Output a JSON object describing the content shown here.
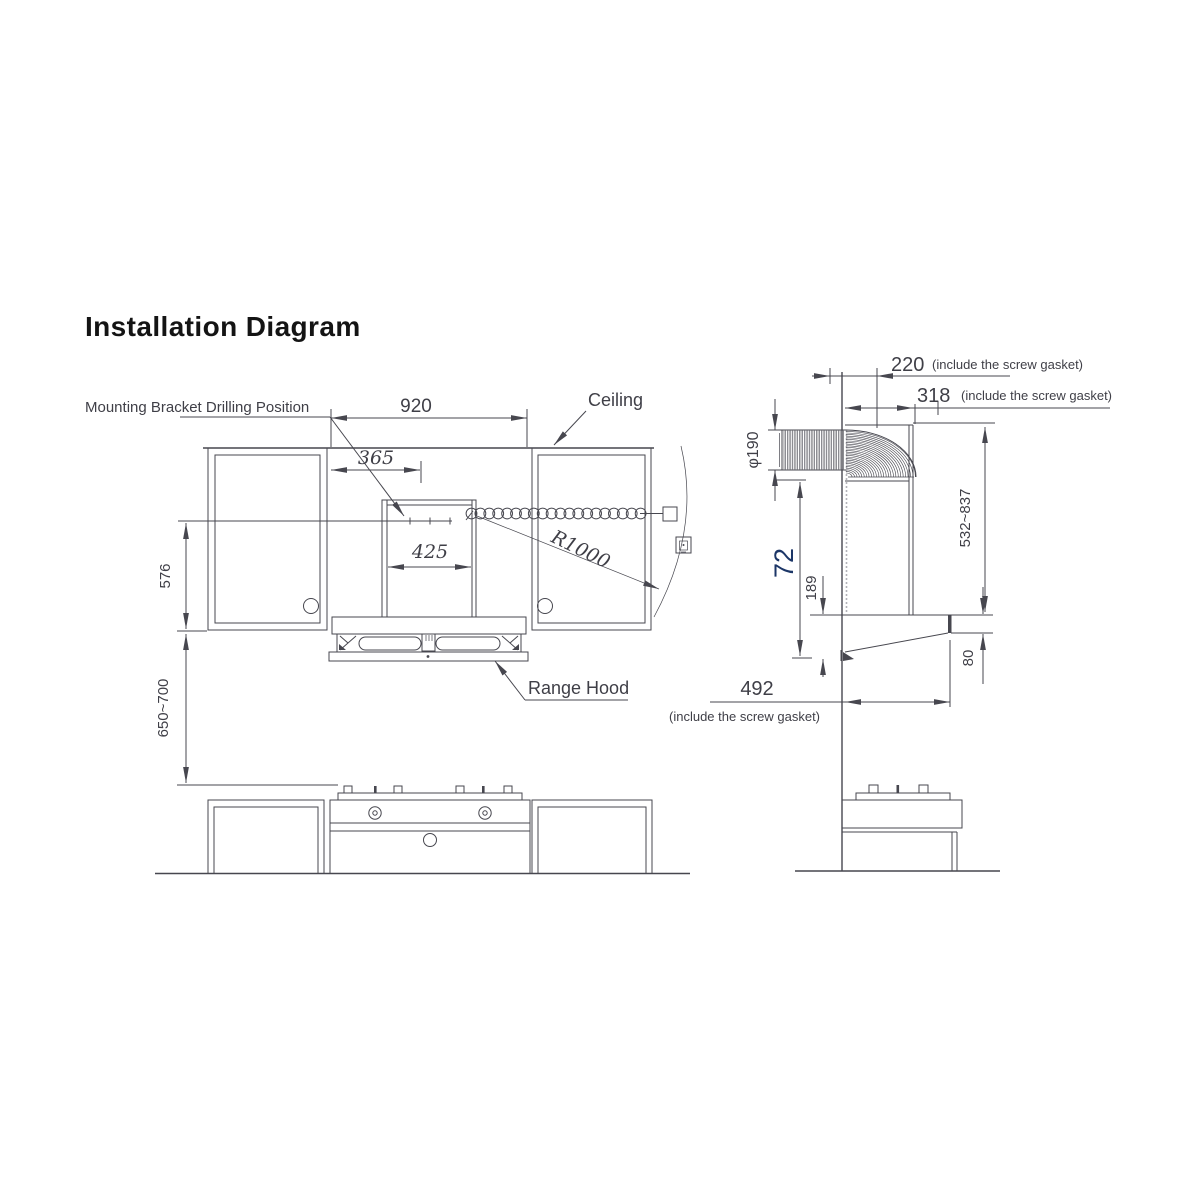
{
  "title": "Installation Diagram",
  "colors": {
    "line": "#47474f",
    "text": "#3f3f47",
    "accent_72": "#1c3667",
    "title": "#141414"
  },
  "front_view": {
    "labels": {
      "mounting": "Mounting Bracket Drilling Position",
      "ceiling": "Ceiling",
      "range_hood": "Range Hood"
    },
    "dims": {
      "width": "920",
      "bracket_offset": "365",
      "duct_width": "425",
      "cabinet_height": "576",
      "hood_to_cooktop": "650~700",
      "cord_radius": "R1000"
    }
  },
  "side_view": {
    "dims": {
      "top_depth": "220",
      "depth": "318",
      "duct_diameter": "φ190",
      "height_72": "72",
      "height_189": "189",
      "chimney_range": "532~837",
      "front_height": "80",
      "total_depth": "492"
    },
    "note": "(include the screw gasket)"
  }
}
